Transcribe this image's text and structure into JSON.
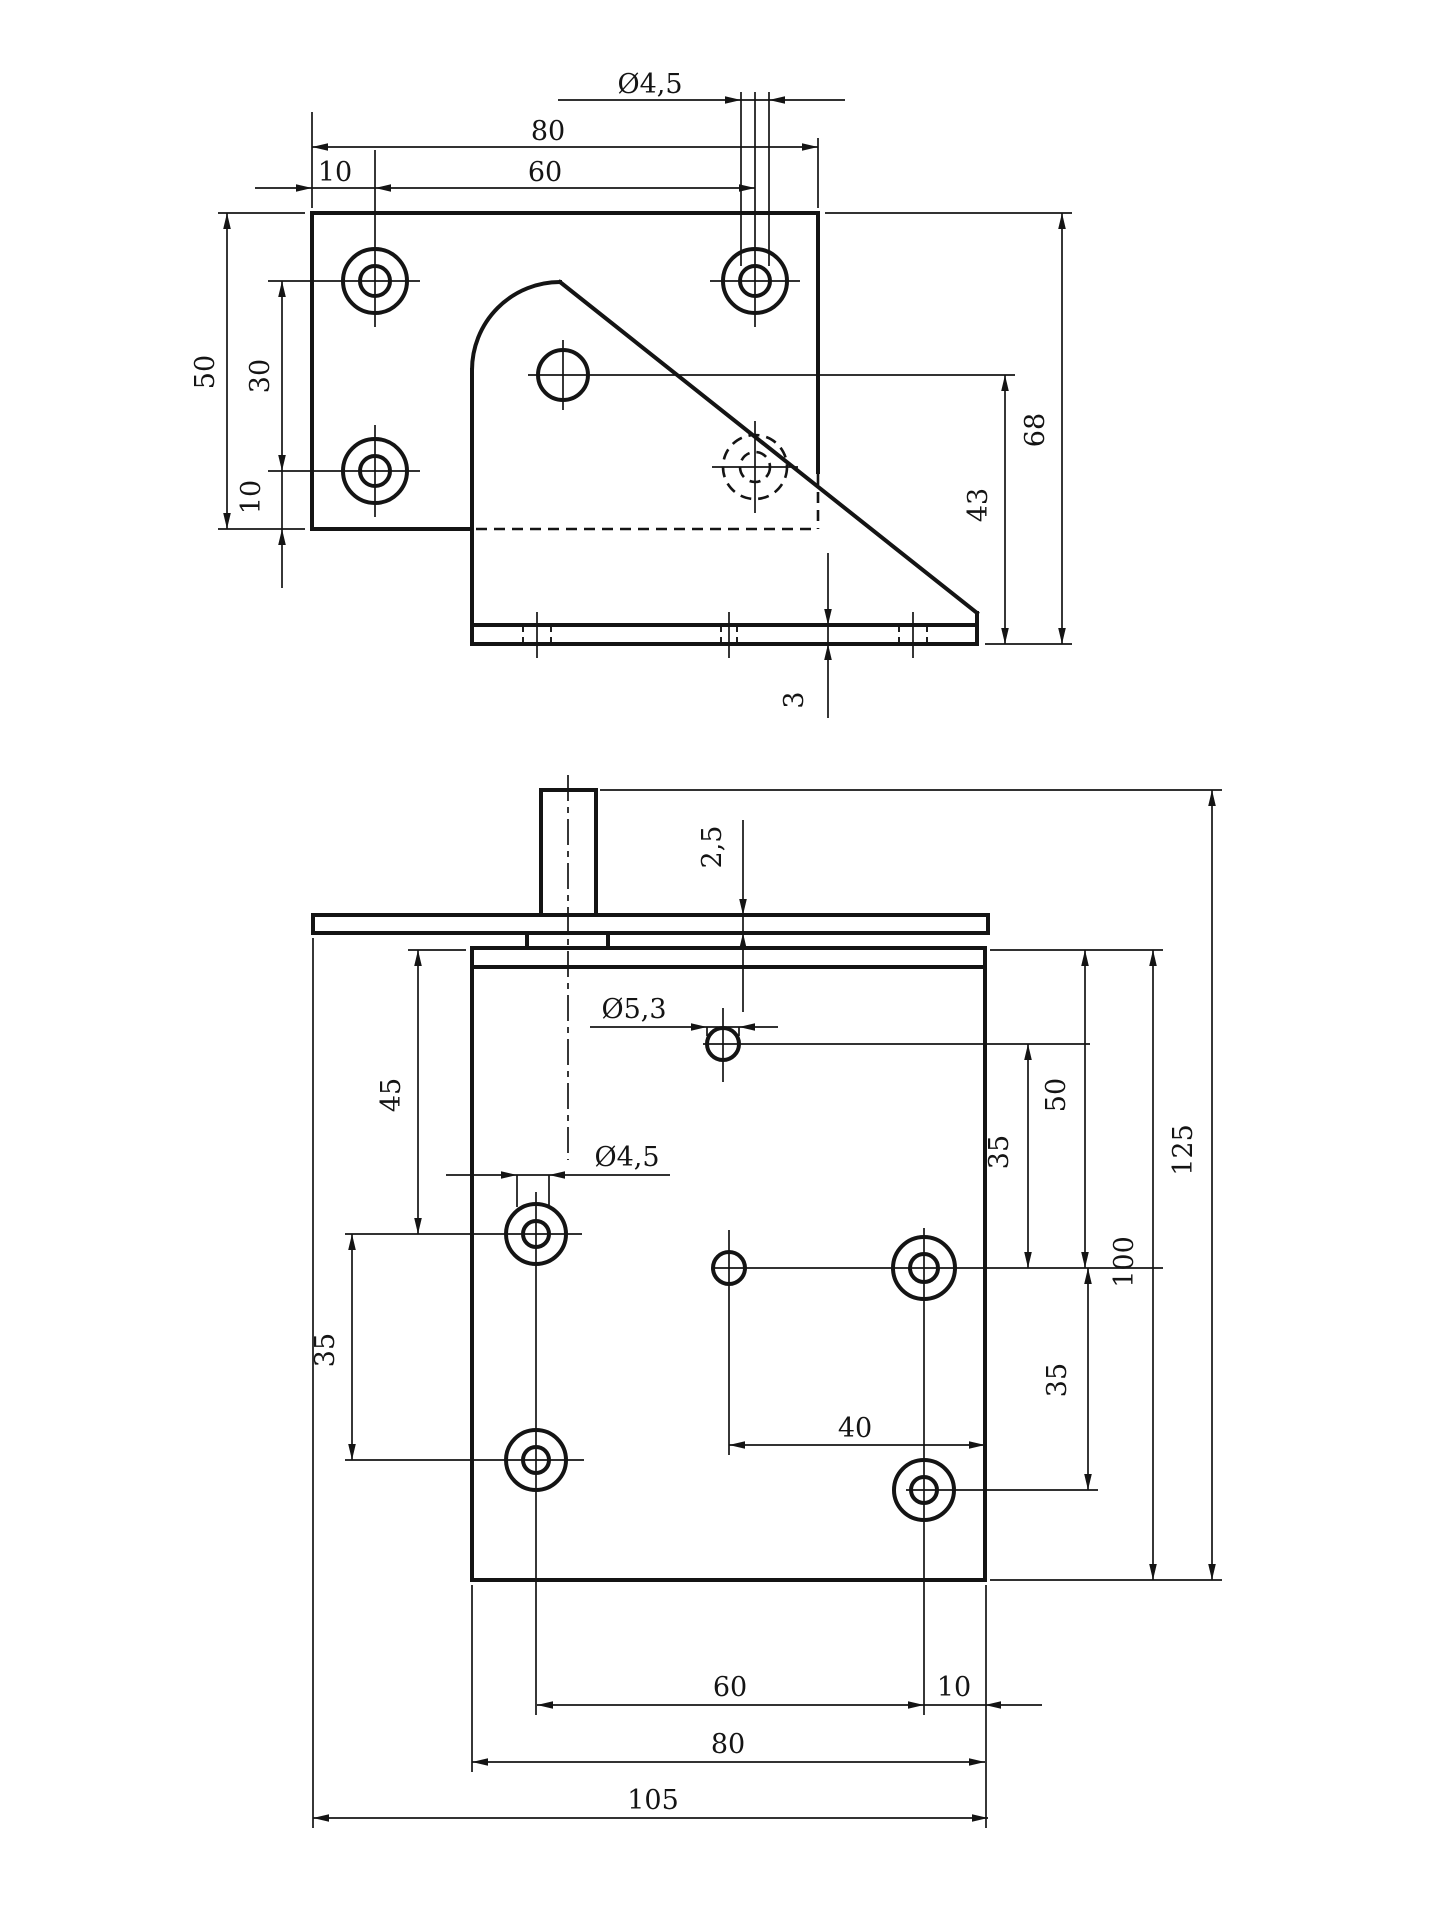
{
  "drawing": {
    "kind": "technical-drawing",
    "ink_color": "#141414",
    "background_color": "#ffffff"
  },
  "views": {
    "side": {
      "name": "bracket-side-elevation",
      "labels": [
        {
          "text": "80",
          "x": 548,
          "y": 140,
          "rot": 0
        },
        {
          "text": "10",
          "x": 335,
          "y": 181,
          "rot": 0
        },
        {
          "text": "60",
          "x": 545,
          "y": 181,
          "rot": 0
        },
        {
          "text": "Ø4,5",
          "x": 650,
          "y": 93,
          "rot": 0
        },
        {
          "text": "50",
          "x": 214,
          "y": 372,
          "rot": -90
        },
        {
          "text": "30",
          "x": 269,
          "y": 376,
          "rot": -90
        },
        {
          "text": "10",
          "x": 260,
          "y": 497,
          "rot": -90
        },
        {
          "text": "43",
          "x": 987,
          "y": 505,
          "rot": -90
        },
        {
          "text": "68",
          "x": 1044,
          "y": 430,
          "rot": -90
        },
        {
          "text": "3",
          "x": 803,
          "y": 700,
          "rot": -90
        }
      ],
      "lines": [
        [
          312,
          213,
          818,
          213,
          "thick"
        ],
        [
          312,
          213,
          312,
          529,
          "thick"
        ],
        [
          312,
          529,
          472,
          529,
          "thick"
        ],
        [
          818,
          213,
          818,
          472,
          "thick"
        ],
        [
          472,
          370,
          472,
          644,
          "thick"
        ],
        [
          560,
          282,
          977,
          613,
          "thick"
        ],
        [
          977,
          613,
          977,
          644,
          "thick"
        ],
        [
          472,
          625,
          977,
          625,
          "thick"
        ],
        [
          472,
          644,
          977,
          644,
          "thick"
        ],
        [
          268,
          281,
          420,
          281,
          "thin"
        ],
        [
          375,
          150,
          375,
          327,
          "thin"
        ],
        [
          710,
          281,
          800,
          281,
          "thin"
        ],
        [
          755,
          92,
          755,
          327,
          "thin"
        ],
        [
          268,
          471,
          420,
          471,
          "thin"
        ],
        [
          375,
          425,
          375,
          517,
          "thin"
        ],
        [
          712,
          467,
          798,
          467,
          "thin"
        ],
        [
          755,
          421,
          755,
          513,
          "thin"
        ],
        [
          528,
          375,
          1015,
          375,
          "thin"
        ],
        [
          563,
          340,
          563,
          410,
          "thin"
        ],
        [
          312,
          147,
          818,
          147,
          "thin"
        ],
        [
          255,
          188,
          755,
          188,
          "thin"
        ],
        [
          558,
          100,
          845,
          100,
          "thin"
        ],
        [
          312,
          208,
          312,
          112,
          "thin"
        ],
        [
          818,
          208,
          818,
          138,
          "thin"
        ],
        [
          741,
          92,
          741,
          266,
          "thin"
        ],
        [
          769,
          92,
          769,
          266,
          "thin"
        ],
        [
          227,
          213,
          227,
          529,
          "thin"
        ],
        [
          218,
          213,
          305,
          213,
          "thin"
        ],
        [
          218,
          529,
          305,
          529,
          "thin"
        ],
        [
          282,
          281,
          282,
          588,
          "thin"
        ],
        [
          1005,
          375,
          1005,
          644,
          "thin"
        ],
        [
          1062,
          213,
          1062,
          644,
          "thin"
        ],
        [
          825,
          213,
          1072,
          213,
          "thin"
        ],
        [
          985,
          644,
          1072,
          644,
          "thin"
        ],
        [
          828,
          553,
          828,
          718,
          "thin"
        ],
        [
          537,
          612,
          537,
          658,
          "thin"
        ],
        [
          729,
          612,
          729,
          658,
          "thin"
        ],
        [
          913,
          612,
          913,
          658,
          "thin"
        ]
      ],
      "dashed_lines": [
        [
          476,
          529,
          816,
          529,
          "dashed"
        ],
        [
          818,
          474,
          818,
          529,
          "dashed"
        ],
        [
          523,
          625,
          523,
          644,
          "dashedthin"
        ],
        [
          551,
          625,
          551,
          644,
          "dashedthin"
        ],
        [
          721,
          625,
          721,
          644,
          "dashedthin"
        ],
        [
          737,
          625,
          737,
          644,
          "dashedthin"
        ],
        [
          899,
          625,
          899,
          644,
          "dashedthin"
        ],
        [
          927,
          625,
          927,
          644,
          "dashedthin"
        ]
      ],
      "circles": [
        [
          375,
          281,
          32,
          "thick"
        ],
        [
          375,
          281,
          15,
          "thick"
        ],
        [
          755,
          281,
          32,
          "thick"
        ],
        [
          755,
          281,
          15,
          "thick"
        ],
        [
          375,
          471,
          32,
          "thick"
        ],
        [
          375,
          471,
          15,
          "thick"
        ],
        [
          563,
          375,
          25,
          "thick"
        ]
      ],
      "dashed_circles": [
        [
          755,
          467,
          32
        ],
        [
          755,
          467,
          15
        ]
      ],
      "arcs": [
        {
          "d": "M 472 370 A 88 88 0 0 1 560 282",
          "cls": "thick"
        }
      ],
      "arrows": [
        [
          312,
          147,
          "left"
        ],
        [
          818,
          147,
          "right"
        ],
        [
          375,
          188,
          "left"
        ],
        [
          755,
          188,
          "right"
        ],
        [
          312,
          188,
          "right"
        ],
        [
          741,
          100,
          "right"
        ],
        [
          769,
          100,
          "left"
        ],
        [
          227,
          213,
          "up"
        ],
        [
          227,
          529,
          "down"
        ],
        [
          282,
          281,
          "up"
        ],
        [
          282,
          471,
          "down"
        ],
        [
          282,
          529,
          "up"
        ],
        [
          1005,
          375,
          "up"
        ],
        [
          1005,
          644,
          "down"
        ],
        [
          1062,
          213,
          "up"
        ],
        [
          1062,
          644,
          "down"
        ],
        [
          828,
          625,
          "down"
        ],
        [
          828,
          644,
          "up"
        ]
      ]
    },
    "plan": {
      "name": "bracket-plan-view",
      "labels": [
        {
          "text": "2,5",
          "x": 721,
          "y": 847,
          "rot": -90
        },
        {
          "text": "Ø5,3",
          "x": 634,
          "y": 1018,
          "rot": 0
        },
        {
          "text": "Ø4,5",
          "x": 627,
          "y": 1166,
          "rot": 0
        },
        {
          "text": "45",
          "x": 400,
          "y": 1095,
          "rot": -90
        },
        {
          "text": "35",
          "x": 334,
          "y": 1350,
          "rot": -90
        },
        {
          "text": "50",
          "x": 1065,
          "y": 1095,
          "rot": -90
        },
        {
          "text": "35",
          "x": 1008,
          "y": 1152,
          "rot": -90
        },
        {
          "text": "100",
          "x": 1133,
          "y": 1262,
          "rot": -90
        },
        {
          "text": "125",
          "x": 1192,
          "y": 1150,
          "rot": -90
        },
        {
          "text": "35",
          "x": 1066,
          "y": 1380,
          "rot": -90
        },
        {
          "text": "40",
          "x": 855,
          "y": 1437,
          "rot": 0
        },
        {
          "text": "60",
          "x": 730,
          "y": 1696,
          "rot": 0
        },
        {
          "text": "10",
          "x": 954,
          "y": 1696,
          "rot": 0
        },
        {
          "text": "80",
          "x": 728,
          "y": 1753,
          "rot": 0
        },
        {
          "text": "105",
          "x": 653,
          "y": 1809,
          "rot": 0
        }
      ],
      "lines": [
        [
          313,
          915,
          988,
          915,
          "thick"
        ],
        [
          313,
          933,
          988,
          933,
          "thick"
        ],
        [
          313,
          915,
          313,
          933,
          "thick"
        ],
        [
          988,
          915,
          988,
          933,
          "thick"
        ],
        [
          541,
          790,
          541,
          915,
          "thick"
        ],
        [
          596,
          790,
          596,
          915,
          "thick"
        ],
        [
          541,
          790,
          596,
          790,
          "thick"
        ],
        [
          527,
          933,
          527,
          947,
          "thick"
        ],
        [
          608,
          933,
          608,
          947,
          "thick"
        ],
        [
          472,
          948,
          985,
          948,
          "thick"
        ],
        [
          472,
          967,
          985,
          967,
          "thick"
        ],
        [
          472,
          948,
          472,
          1580,
          "thick"
        ],
        [
          985,
          948,
          985,
          1580,
          "thick"
        ],
        [
          472,
          1580,
          985,
          1580,
          "thick"
        ],
        [
          703,
          1044,
          1090,
          1044,
          "thin"
        ],
        [
          723,
          1008,
          723,
          1082,
          "thin"
        ],
        [
          345,
          1234,
          582,
          1234,
          "thin"
        ],
        [
          536,
          1192,
          536,
          1715,
          "thin"
        ],
        [
          712,
          1268,
          1163,
          1268,
          "thin"
        ],
        [
          729,
          1230,
          729,
          1455,
          "thin"
        ],
        [
          924,
          1228,
          924,
          1715,
          "thin"
        ],
        [
          345,
          1460,
          584,
          1460,
          "thin"
        ],
        [
          906,
          1490,
          1098,
          1490,
          "thin"
        ],
        [
          743,
          820,
          743,
          1012,
          "thin"
        ],
        [
          590,
          1027,
          778,
          1027,
          "thin"
        ],
        [
          707,
          1027,
          707,
          1036,
          "thin"
        ],
        [
          739,
          1027,
          739,
          1036,
          "thin"
        ],
        [
          446,
          1175,
          670,
          1175,
          "thin"
        ],
        [
          517,
          1175,
          517,
          1207,
          "thin"
        ],
        [
          549,
          1175,
          549,
          1207,
          "thin"
        ],
        [
          418,
          950,
          418,
          1234,
          "thin"
        ],
        [
          408,
          950,
          466,
          950,
          "thin"
        ],
        [
          352,
          1234,
          352,
          1460,
          "thin"
        ],
        [
          990,
          950,
          1163,
          950,
          "thin"
        ],
        [
          1085,
          950,
          1085,
          1268,
          "thin"
        ],
        [
          1028,
          1044,
          1028,
          1268,
          "thin"
        ],
        [
          1153,
          950,
          1153,
          1580,
          "thin"
        ],
        [
          600,
          790,
          1222,
          790,
          "thin"
        ],
        [
          1212,
          790,
          1212,
          1580,
          "thin"
        ],
        [
          990,
          1580,
          1222,
          1580,
          "thin"
        ],
        [
          1088,
          1268,
          1088,
          1490,
          "thin"
        ],
        [
          729,
          1445,
          985,
          1445,
          "thin"
        ],
        [
          537,
          1705,
          1042,
          1705,
          "thin"
        ],
        [
          472,
          1762,
          985,
          1762,
          "thin"
        ],
        [
          313,
          1818,
          988,
          1818,
          "thin"
        ],
        [
          472,
          1585,
          472,
          1772,
          "thin"
        ],
        [
          986,
          1585,
          986,
          1828,
          "thin"
        ],
        [
          313,
          938,
          313,
          1828,
          "thin"
        ]
      ],
      "dashed_lines": [],
      "circles": [
        [
          723,
          1044,
          16,
          "thick"
        ],
        [
          536,
          1234,
          30,
          "thick"
        ],
        [
          536,
          1234,
          13,
          "thick"
        ],
        [
          729,
          1268,
          16,
          "thick"
        ],
        [
          924,
          1268,
          31,
          "thick"
        ],
        [
          924,
          1268,
          14,
          "thick"
        ],
        [
          536,
          1460,
          30,
          "thick"
        ],
        [
          536,
          1460,
          13,
          "thick"
        ],
        [
          924,
          1490,
          30,
          "thick"
        ],
        [
          924,
          1490,
          13,
          "thick"
        ]
      ],
      "dashed_circles": [],
      "arcs": [],
      "arrows": [
        [
          743,
          915,
          "down"
        ],
        [
          743,
          933,
          "up"
        ],
        [
          707,
          1027,
          "right"
        ],
        [
          739,
          1027,
          "left"
        ],
        [
          517,
          1175,
          "right"
        ],
        [
          549,
          1175,
          "left"
        ],
        [
          418,
          950,
          "up"
        ],
        [
          418,
          1234,
          "down"
        ],
        [
          352,
          1234,
          "up"
        ],
        [
          352,
          1460,
          "down"
        ],
        [
          1085,
          950,
          "up"
        ],
        [
          1085,
          1268,
          "down"
        ],
        [
          1028,
          1044,
          "up"
        ],
        [
          1028,
          1268,
          "down"
        ],
        [
          1153,
          950,
          "up"
        ],
        [
          1153,
          1580,
          "down"
        ],
        [
          1212,
          790,
          "up"
        ],
        [
          1212,
          1580,
          "down"
        ],
        [
          1088,
          1268,
          "up"
        ],
        [
          1088,
          1490,
          "down"
        ],
        [
          729,
          1445,
          "left"
        ],
        [
          985,
          1445,
          "right"
        ],
        [
          537,
          1705,
          "left"
        ],
        [
          924,
          1705,
          "right"
        ],
        [
          985,
          1705,
          "left"
        ],
        [
          472,
          1762,
          "left"
        ],
        [
          985,
          1762,
          "right"
        ],
        [
          313,
          1818,
          "left"
        ],
        [
          988,
          1818,
          "right"
        ]
      ],
      "center_lines": [
        [
          568,
          775,
          568,
          1160
        ]
      ]
    }
  }
}
